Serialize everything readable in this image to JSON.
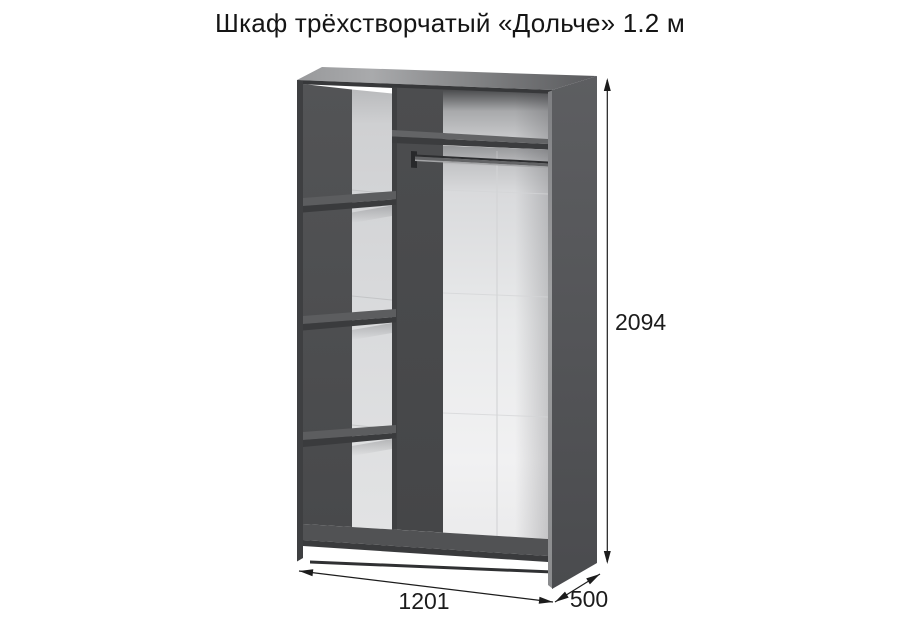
{
  "title": "Шкаф трёхстворчатый «Дольче» 1.2 м",
  "product": {
    "kind": "wardrobe-three-door-dimension-diagram"
  },
  "dimensions": {
    "height": "2094",
    "width": "1201",
    "depth": "500"
  },
  "colors": {
    "body_dark": "#48494b",
    "panel_edge_dark": "#3a3b3d",
    "back_panel_white": "#e7e8e9",
    "top_face_light": "#a9aaac",
    "dimension_lines": "#1c1c1c",
    "background": "#ffffff"
  }
}
